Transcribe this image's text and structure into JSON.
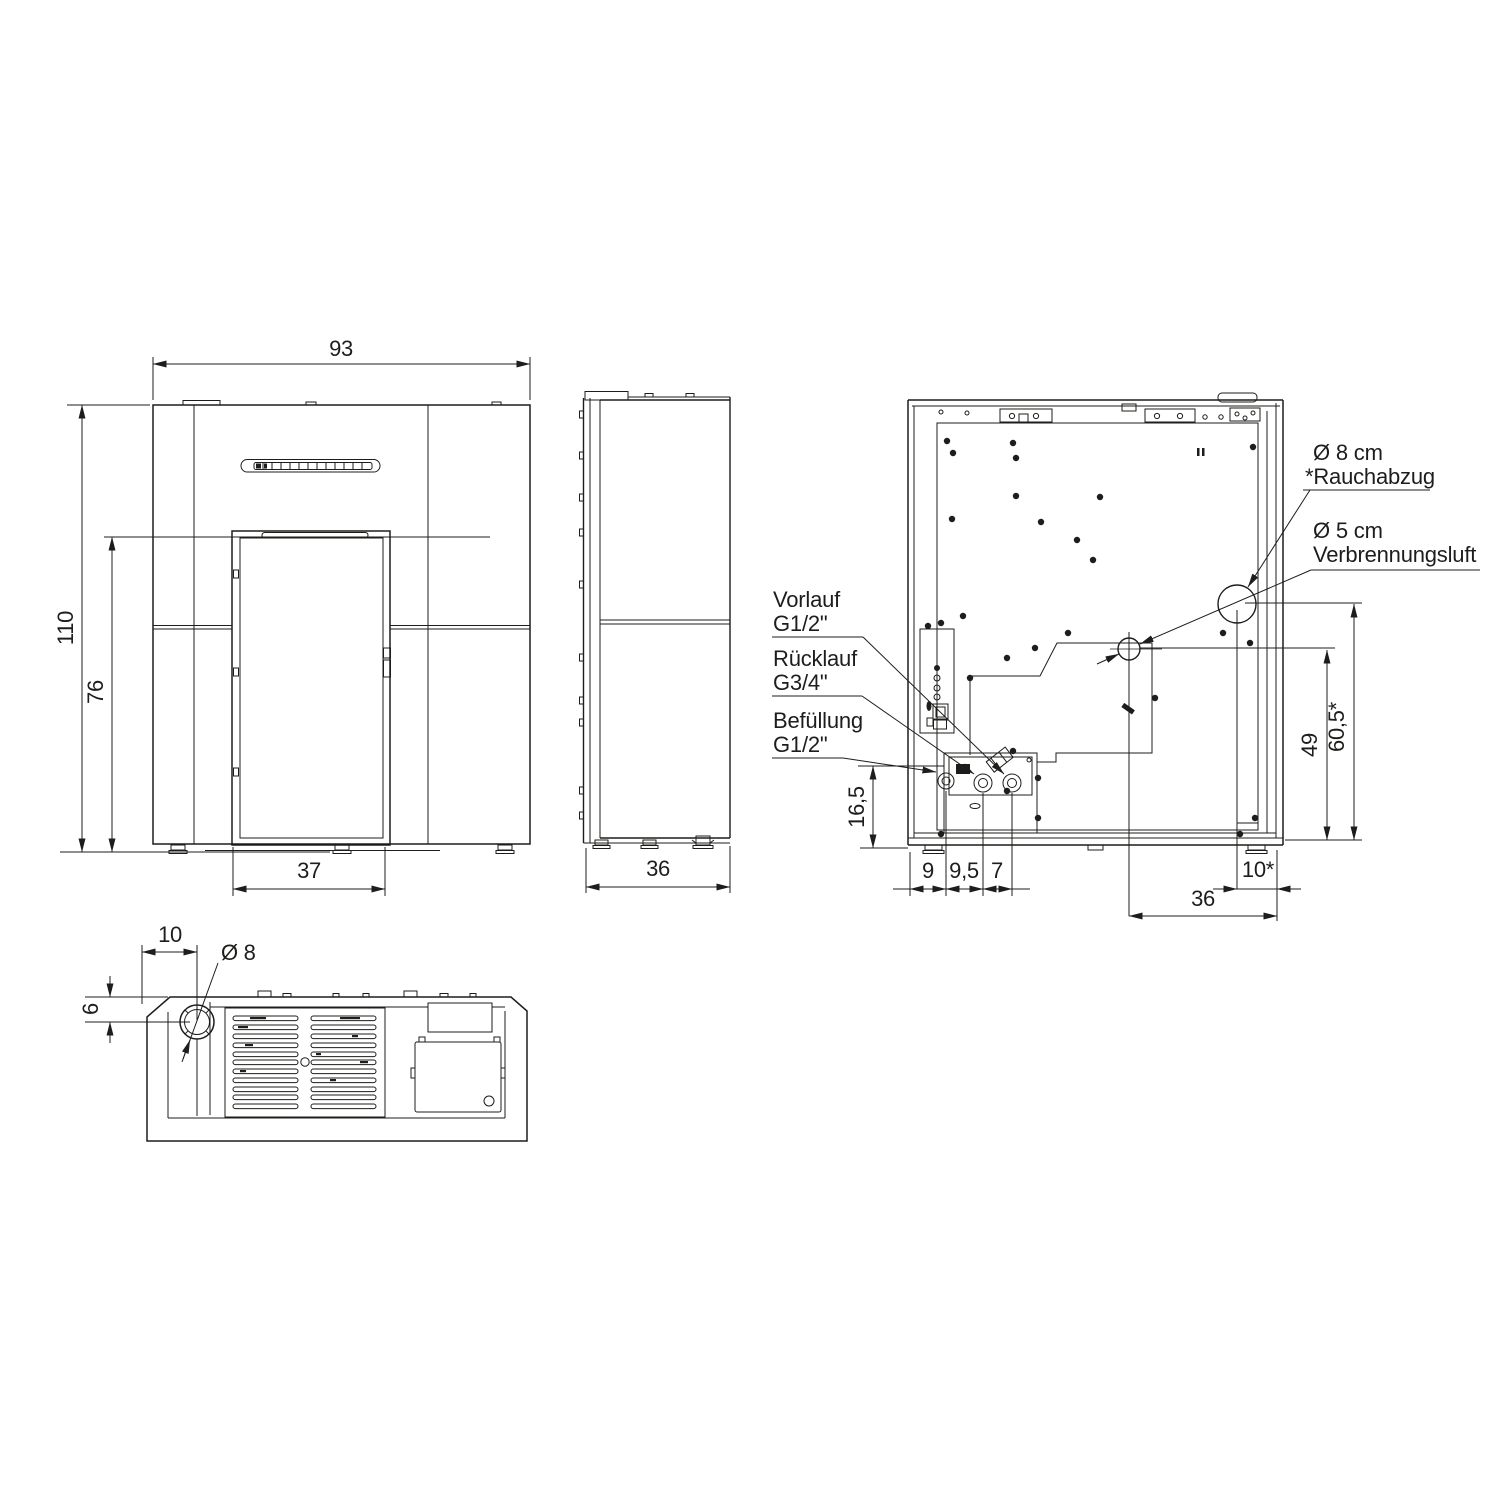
{
  "drawing": {
    "colors": {
      "line": "#1d1d1b",
      "background": "#ffffff"
    },
    "front_view": {
      "dim_width": "93",
      "dim_height": "110",
      "dim_door_top": "76",
      "dim_door_width": "37"
    },
    "side_view": {
      "dim_depth": "36"
    },
    "rear_view": {
      "callout_vorlauf_line1": "Vorlauf",
      "callout_vorlauf_line2": "G1/2\"",
      "callout_ruecklauf_line1": "Rücklauf",
      "callout_ruecklauf_line2": "G3/4\"",
      "callout_befuellung_line1": "Befüllung",
      "callout_befuellung_line2": "G1/2\"",
      "callout_rauchabzug_line1": "Ø 8 cm",
      "callout_rauchabzug_line2": "*Rauchabzug",
      "callout_verbrennungsluft_line1": "Ø 5 cm",
      "callout_verbrennungsluft_line2": "Verbrennungsluft",
      "dim_offset_bottom": "16,5",
      "dim_seg_1": "9",
      "dim_seg_2": "9,5",
      "dim_seg_3": "7",
      "dim_air_height": "49",
      "dim_flue_height": "60,5*",
      "dim_flue_side": "10*",
      "dim_air_side": "36"
    },
    "bottom_view": {
      "dim_pipe_offset": "10",
      "dim_pipe_diameter": "Ø 8",
      "dim_pipe_depth": "6"
    }
  }
}
